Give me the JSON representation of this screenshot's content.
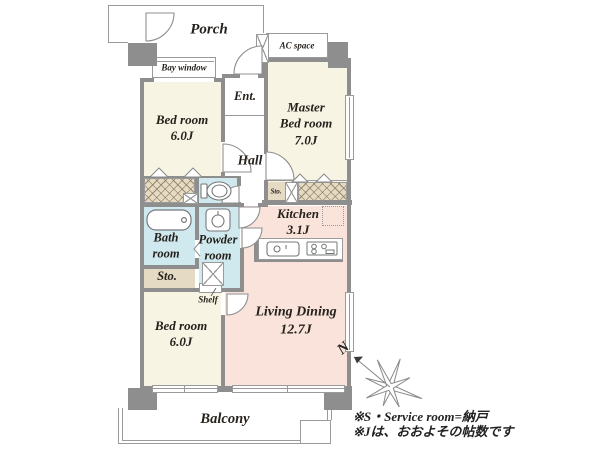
{
  "colors": {
    "room_cream": "#f7f4e3",
    "room_pink": "#f9e3da",
    "room_blue": "#cfe9ee",
    "storage_beige": "#e5dac4",
    "wall_gray": "#8e8e8e",
    "line_gray": "#9a9a9a",
    "text_color": "#26211c"
  },
  "rooms": {
    "porch": {
      "label": "Porch"
    },
    "bay_window": {
      "label": "Bay window"
    },
    "ac_space": {
      "label": "AC space"
    },
    "bedroom_top": {
      "label": "Bed room",
      "size": "6.0J"
    },
    "entrance": {
      "label": "Ent."
    },
    "hall": {
      "label": "Hall"
    },
    "master_bedroom": {
      "label_line1": "Master",
      "label_line2": "Bed room",
      "size": "7.0J"
    },
    "kitchen": {
      "label": "Kitchen",
      "size": "3.1J"
    },
    "living_dining": {
      "label": "Living Dining",
      "size": "12.7J"
    },
    "bath": {
      "label_line1": "Bath",
      "label_line2": "room"
    },
    "powder": {
      "label_line1": "Powder",
      "label_line2": "room"
    },
    "storage_mid": {
      "label": "Sto."
    },
    "storage_lower": {
      "label": "Sto."
    },
    "shelf": {
      "label": "Shelf"
    },
    "bedroom_bottom": {
      "label": "Bed room",
      "size": "6.0J"
    },
    "balcony": {
      "label": "Balcony"
    }
  },
  "compass": {
    "label": "N"
  },
  "footnotes": {
    "line1": "※S・Service room=納戸",
    "line2": "※Jは、おおよその帖数です"
  }
}
